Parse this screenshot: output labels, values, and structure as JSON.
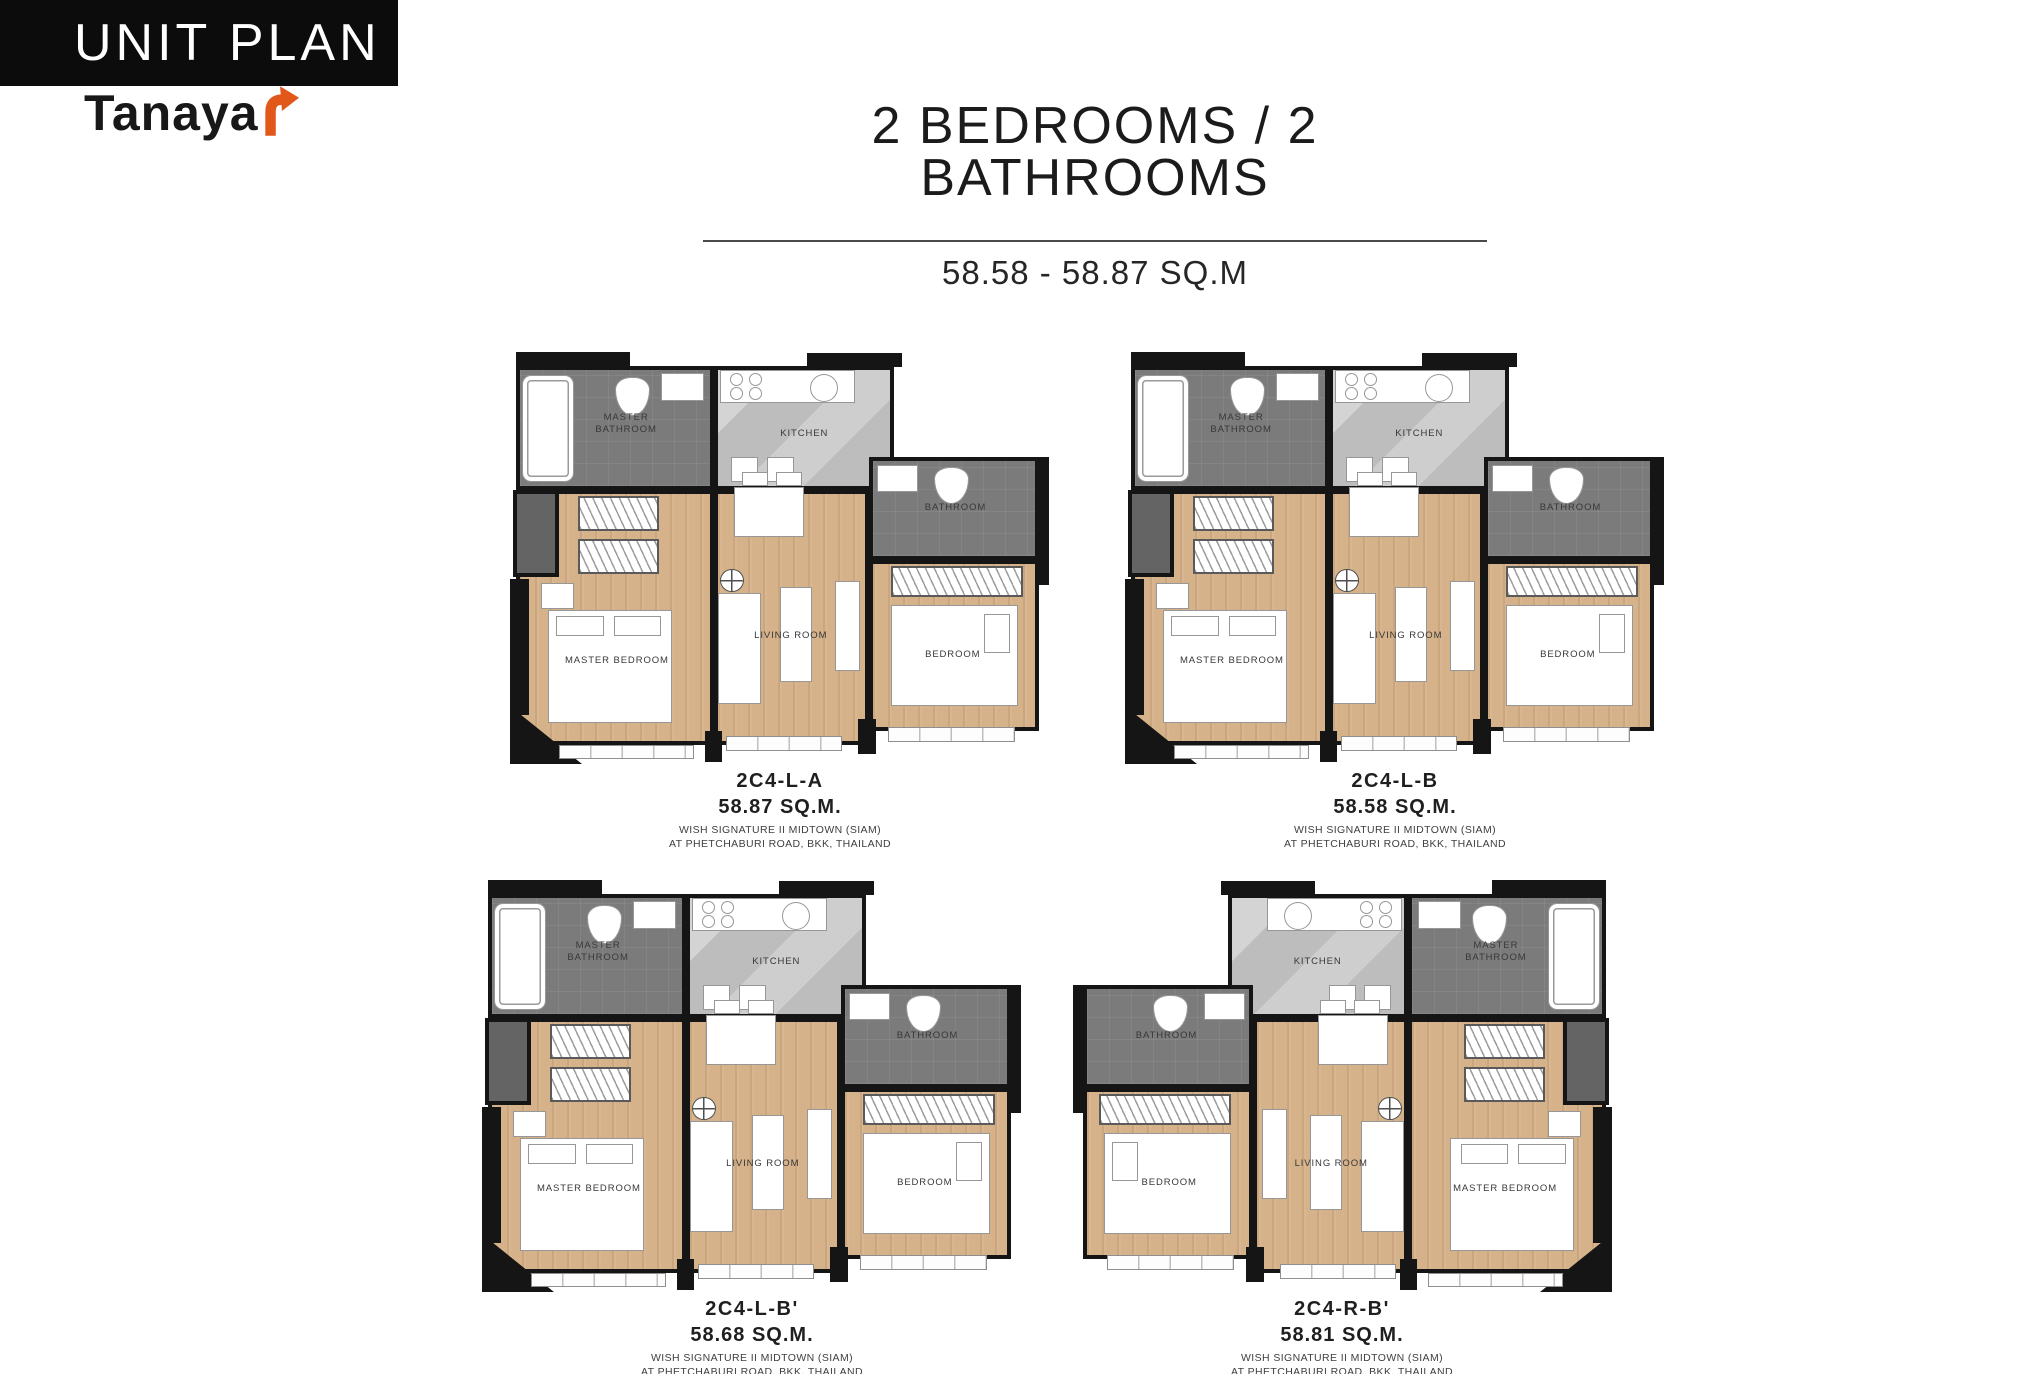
{
  "header": {
    "banner_title": "UNIT PLAN",
    "brand_name": "Tanaya",
    "title": "2 BEDROOMS / 2 BATHROOMS",
    "subtitle": "58.58 - 58.87 SQ.M"
  },
  "room_labels": {
    "master_bathroom": "MASTER BATHROOM",
    "kitchen": "KITCHEN",
    "bathroom": "BATHROOM",
    "master_bedroom": "MASTER BEDROOM",
    "living_room": "LIVING ROOM",
    "bedroom": "BEDROOM"
  },
  "units": [
    {
      "code": "2C4-L-A",
      "area": "58.87 SQ.M.",
      "project_line1": "WISH SIGNATURE II MIDTOWN (SIAM)",
      "project_line2": "AT PHETCHABURI ROAD, BKK, THAILAND",
      "mirrored": false
    },
    {
      "code": "2C4-L-B",
      "area": "58.58 SQ.M.",
      "project_line1": "WISH SIGNATURE II MIDTOWN (SIAM)",
      "project_line2": "AT PHETCHABURI ROAD, BKK, THAILAND",
      "mirrored": false
    },
    {
      "code": "2C4-L-B'",
      "area": "58.68 SQ.M.",
      "project_line1": "WISH SIGNATURE II MIDTOWN (SIAM)",
      "project_line2": "AT PHETCHABURI ROAD, BKK, THAILAND",
      "mirrored": false
    },
    {
      "code": "2C4-R-B'",
      "area": "58.81 SQ.M.",
      "project_line1": "WISH SIGNATURE II MIDTOWN (SIAM)",
      "project_line2": "AT PHETCHABURI ROAD, BKK, THAILAND",
      "mirrored": true
    }
  ],
  "colors": {
    "banner_bg": "#0c0c0c",
    "banner_text": "#ffffff",
    "brand_text": "#181818",
    "brand_arrow": "#e2571a",
    "wall": "#151515",
    "wet_room": "#7b7b7b",
    "kitchen_floor": "#bdbdbd",
    "wood_floor": "#d6b28a",
    "furniture": "#ffffff",
    "room_label_text": "#383838"
  }
}
